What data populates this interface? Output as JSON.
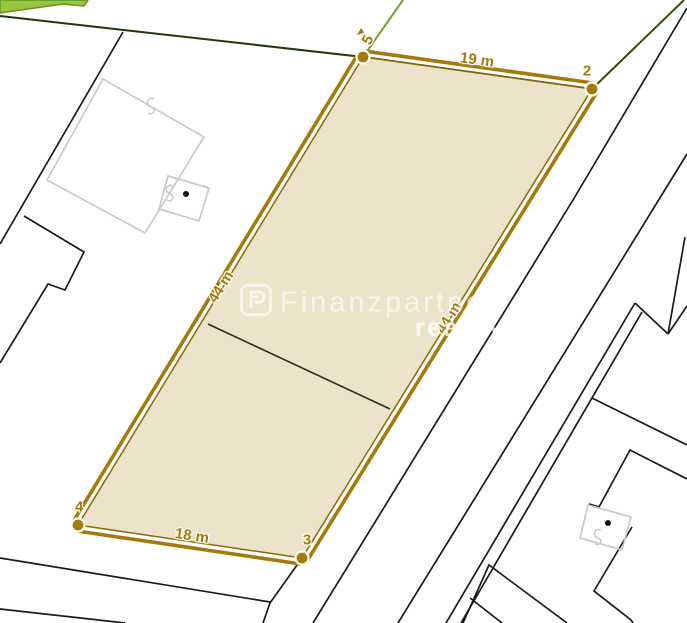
{
  "map": {
    "parcel": {
      "edges": {
        "top": {
          "label": "19 m"
        },
        "right": {
          "label": "44 m"
        },
        "bottom": {
          "label": "18 m"
        },
        "left": {
          "label": "44 m"
        }
      },
      "points": {
        "p5": {
          "label": "5"
        },
        "p2": {
          "label": "2"
        },
        "p3": {
          "label": "3"
        },
        "p4": {
          "label": "4"
        }
      }
    },
    "watermark": {
      "brand": "Finanzpartner",
      "registered": "®",
      "subbrand": "reality"
    },
    "colors": {
      "parcel_fill": "#EDE3CA",
      "boundary_gold": "#A5790A",
      "plot_line_black": "#1a1a1a",
      "building_gray": "#c9c9c9",
      "cadastre_green_dark": "#22380b",
      "cadastre_green_mid": "#6fa035",
      "greenery_fill": "#9cc43d"
    }
  }
}
